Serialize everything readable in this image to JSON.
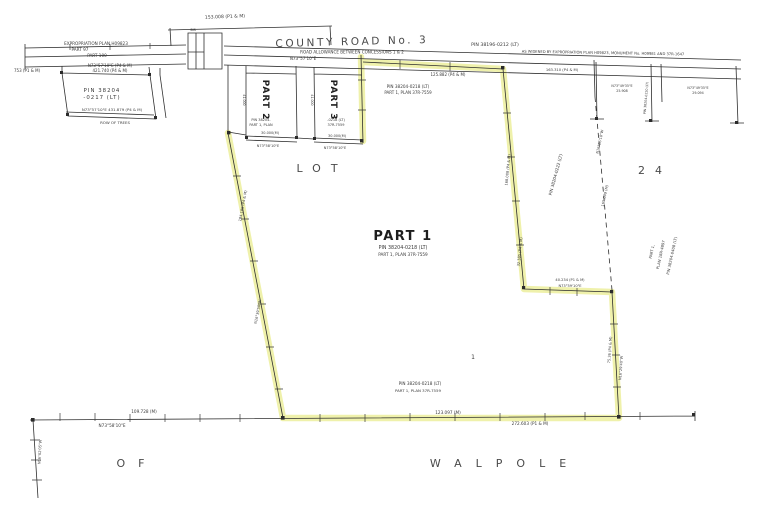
{
  "colors": {
    "highlight": "#edf0a2",
    "ink": "#2f2f2f",
    "paper": "#ffffff"
  },
  "road": {
    "name": "COUNTY ROAD No. 3",
    "allowance": "ROAD ALLOWANCE BETWEEN CONCESSIONS 1 & 2",
    "bearing": "N73°57'10\"E",
    "pin": "PIN 38196-0212 (LT)",
    "widened": "AS WIDENED BY EXPROPRIATION PLAN H09823, MONUMENT No. H09981 AND 37R-1647",
    "dim_top": "153.008 (P1 & M)",
    "dim_left": "753 (P1 & M)",
    "dim_mid": "125.882 (P4 & M)",
    "dim_mid2": "163.310 (P4 & M)"
  },
  "expro": {
    "line1": "EXPROPRIATION PLAN H09823",
    "line2": "PART 97",
    "line3": "PART 100"
  },
  "p0217": {
    "pin1": "PIN 38204",
    "pin2": "-0217 (LT)",
    "top_bearing": "N73°57'10\"E  (P4 & M)",
    "top_dim": "421.740 (P4 & M)",
    "bottom_dim": "N73°57'10\"E   431.879 (P4 & M)",
    "trees": "ROW OF TREES"
  },
  "part2": {
    "name": "PART 2",
    "pin": "PIN 38204-",
    "plan": "PART 1, PLAN",
    "width": "30.000(M)",
    "bearing": "N73°58'10\"E",
    "side": "41.000"
  },
  "part3": {
    "name": "PART 3",
    "pin": "-0218 (LT)",
    "plan": "37R-7559",
    "width": "30.000(M)",
    "bearing": "N73°58'10\"E",
    "side": "41.000"
  },
  "part1": {
    "name": "PART 1",
    "pin": "PIN 38204-0218 (LT)",
    "plan": "PART 1, PLAN 37R-7559",
    "pin_top": "PIN 38204-0218 (LT)",
    "plan_top": "PART 1, PLAN 37R-7559",
    "pin_bottom": "PIN 38204-0218 (LT)",
    "plan_bottom": "PART 1, PLAN 37R-7559",
    "west_dim": "184.185 (P4 & M)",
    "west_bearing": "N16°39'50\"W",
    "east_dim_upper": "168.008 (P4 & M)",
    "east_dim_lower": "32.385 (P4 & M)",
    "jog_dim": "40.234 (P1 & M)",
    "jog_bearing": "N73°59'10\"E",
    "south_dim": "75.36 (P4 & M)",
    "south_bearing": "N16°29'40\"W",
    "interior_mark": "1"
  },
  "lot": {
    "word": "LOT",
    "number": "24"
  },
  "east": {
    "pin0222": "PIN 38204-0222 (LT)",
    "dash_bearing": "N16°26'10\"W",
    "dash_dim": "165.049 (M)",
    "pin0408": "PIN 38204-0408 (LT)",
    "pin0408_b": "PART 1,",
    "pin0408_c": "PLAN 18R-4897"
  },
  "ne": {
    "bearing1": "N73°49'35\"E",
    "dim1": "25.908",
    "bearing2": "N73°49'35\"E",
    "dim2": "29.094",
    "pin": "PIN 38204-0220 (LT)"
  },
  "bottom": {
    "dim1": "109.728 (M)",
    "bearing1": "N73°58'10\"E",
    "dim2": "123.097 (M)",
    "dim3": "272.603 (P1 & M)",
    "west_bearing": "N16°02'05\"W"
  },
  "township": {
    "of": "OF",
    "name": "WALPOLE"
  },
  "monument": {
    "sib": "SIB"
  }
}
